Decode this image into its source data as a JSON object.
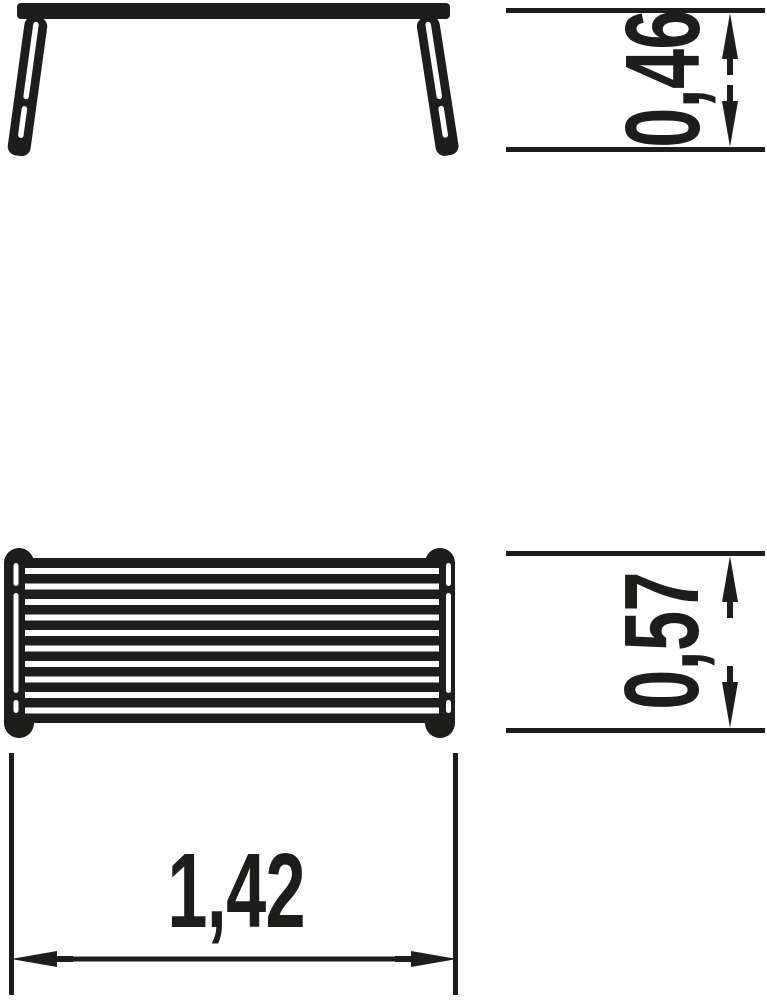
{
  "drawing": {
    "ink_color": "#1d1d1b",
    "plan_view": {
      "slat_gap_count": 10,
      "gap_start_y": 568,
      "gap_step": 15.5,
      "gap_height": 6,
      "gap_x": 25,
      "gap_width": 414
    },
    "dimensions": {
      "height": {
        "label": "0,46"
      },
      "depth": {
        "label": "0,57"
      },
      "width": {
        "label": "1,42"
      }
    }
  }
}
